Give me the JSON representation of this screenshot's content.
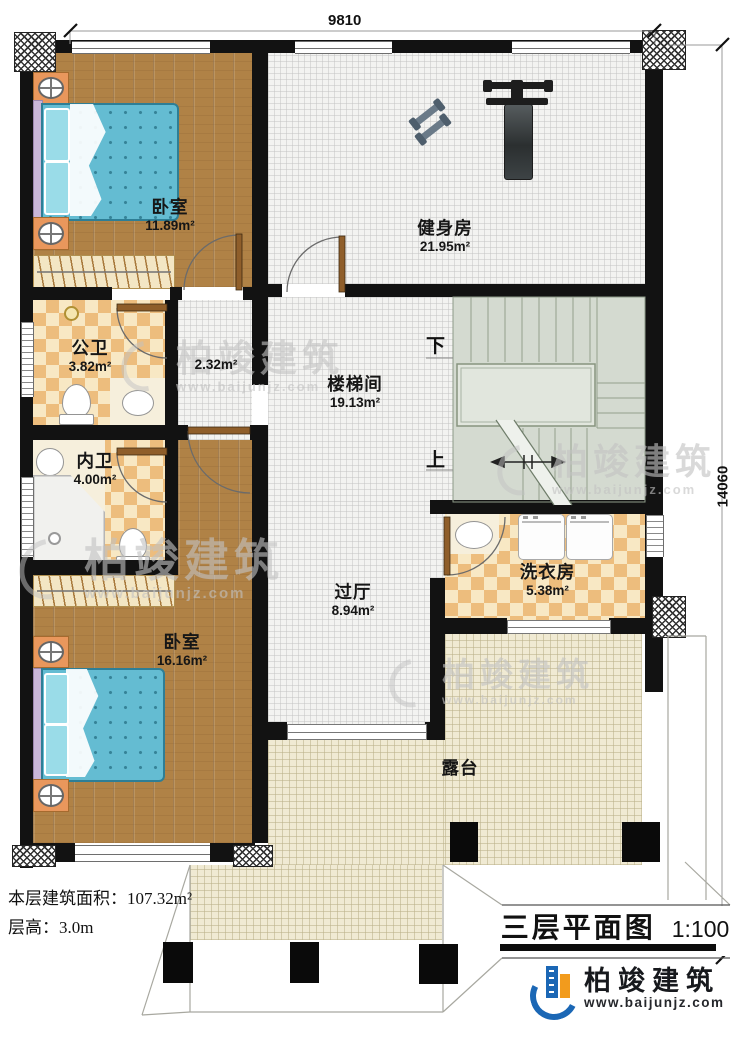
{
  "title": {
    "text": "三层平面图",
    "scale": "1:100"
  },
  "dimensions": {
    "width": "9810",
    "height": "14060"
  },
  "info": {
    "area": "本层建筑面积：107.32m²",
    "floor_height": "层高：3.0m"
  },
  "rooms": [
    {
      "name": "卧室",
      "area": "11.89m²"
    },
    {
      "name": "健身房",
      "area": "21.95m²"
    },
    {
      "name": "公卫",
      "area": "3.82m²"
    },
    {
      "name": "",
      "area": "2.32m²"
    },
    {
      "name": "楼梯间",
      "area": "19.13m²"
    },
    {
      "name": "内卫",
      "area": "4.00m²"
    },
    {
      "name": "过厅",
      "area": "8.94m²"
    },
    {
      "name": "洗衣房",
      "area": "5.38m²"
    },
    {
      "name": "卧室",
      "area": "16.16m²"
    },
    {
      "name": "露台",
      "area": ""
    }
  ],
  "stairs": {
    "down": "下",
    "up": "上"
  },
  "logo": {
    "name": "柏竣建筑",
    "website": "www.baijunjz.com"
  },
  "watermark": {
    "name": "柏竣建筑",
    "website": "www.baijunjz.com"
  },
  "colors": {
    "wall": "#121212",
    "wood_floor": "#b08246",
    "tile_checker": "#edbd7d",
    "stair_floor": "#d4dad0",
    "terrace_floor": "#f0ead3",
    "bed": "#64bcd2",
    "logo_blue": "#1b67b5",
    "logo_orange": "#f29b1d"
  }
}
